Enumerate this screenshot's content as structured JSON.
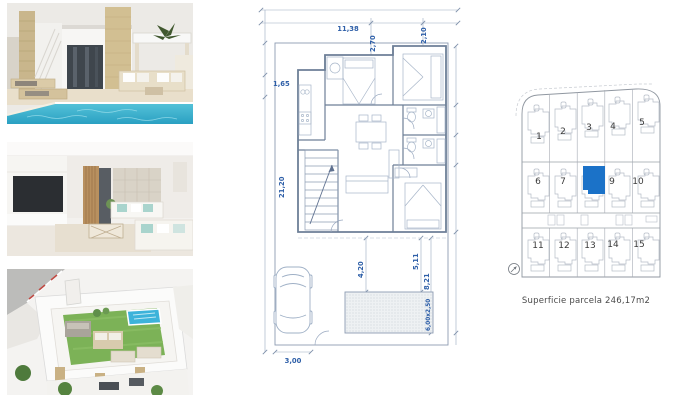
{
  "thumbnails": [
    {
      "id": "villa-exterior-pool"
    },
    {
      "id": "living-room-interior"
    },
    {
      "id": "roof-terrace-aerial"
    }
  ],
  "floor_plan": {
    "accent_color": "#2e5fa8",
    "line_color": "#9aa9c0",
    "wall_color": "#6d7f97",
    "dimensions": {
      "top_width": "11,38",
      "top_offset": "2,70",
      "top_right_room": "2,10",
      "left_upper": "1,65",
      "left_total": "21,20",
      "terrace_left": "4,20",
      "terrace_right": "5,11",
      "garden_right": "8,21",
      "pool_size": "6,00x2,50",
      "bottom_drive": "3,00"
    }
  },
  "site_plan": {
    "highlight_color": "#1b72c8",
    "caption": "Superficie parcela 246,17m2",
    "plots": [
      {
        "label": "1",
        "highlighted": false
      },
      {
        "label": "2",
        "highlighted": false
      },
      {
        "label": "3",
        "highlighted": false
      },
      {
        "label": "4",
        "highlighted": false
      },
      {
        "label": "5",
        "highlighted": false
      },
      {
        "label": "6",
        "highlighted": false
      },
      {
        "label": "7",
        "highlighted": false
      },
      {
        "label": "",
        "highlighted": true
      },
      {
        "label": "9",
        "highlighted": false
      },
      {
        "label": "10",
        "highlighted": false
      },
      {
        "label": "11",
        "highlighted": false
      },
      {
        "label": "12",
        "highlighted": false
      },
      {
        "label": "13",
        "highlighted": false
      },
      {
        "label": "14",
        "highlighted": false
      },
      {
        "label": "15",
        "highlighted": false
      }
    ]
  }
}
